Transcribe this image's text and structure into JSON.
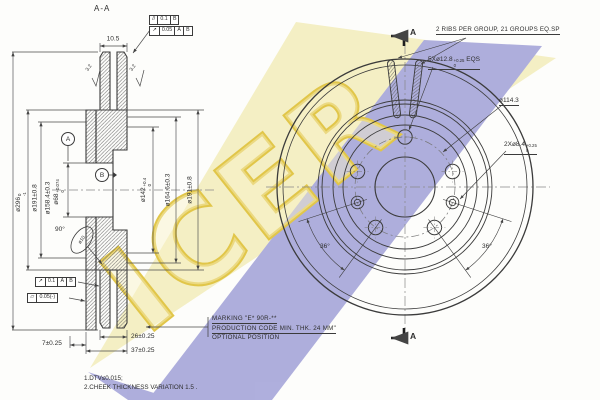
{
  "title": "A-A",
  "watermark": {
    "text": "ICER",
    "yellow": "#f4eec0",
    "blue": "#a9a9da",
    "letter": "#dfc23c"
  },
  "left_view": {
    "dim_top": "10.5",
    "finish_left": "3.2",
    "finish_right": "3.2",
    "dia296": {
      "main": "ø296",
      "tt": "0",
      "tb": "-1"
    },
    "dia191_left": "ø191±0.8",
    "dia158": "ø158.4±0.3",
    "dia68": {
      "main": "ø68",
      "tt": "+0.074",
      "tb": "0"
    },
    "dia142": {
      "main": "ø142",
      "tt": "+0.4",
      "tb": "0"
    },
    "dia164": "ø164.6±0.3",
    "dia191_right": "ø191±0.8",
    "angle90": "90°",
    "balloon": "ø10",
    "dim26": "26±0.25",
    "dim37": "37±0.25",
    "dim7": "7±0.25",
    "datumA": "A",
    "datumB": "B",
    "fcf_parallel": {
      "sym": "//",
      "val": "0.1",
      "r1": "B"
    },
    "fcf_runout_small": {
      "sym": "↗",
      "val": "0.05",
      "r1": "A",
      "r2": "B"
    },
    "fcf_runout": {
      "sym": "↗",
      "val": "0.1",
      "r1": "A",
      "r2": "B"
    },
    "fcf_flatness": {
      "sym": "▱",
      "val": "0.05(-)"
    }
  },
  "right_view": {
    "ribs_note": "2 RIBS PER GROUP, 21 GROUPS EQ.SP",
    "holes5": {
      "main": "5Xø12.8",
      "tt": "+0.25",
      "tb": "0",
      "suffix": "EQS"
    },
    "bolt_circle": "ø114.3",
    "holes2": {
      "main": "2Xø8.4",
      "tt": "+0.25",
      "tb": "0"
    },
    "angle_left": "36°",
    "angle_right": "36°",
    "flag_top": "A",
    "flag_bottom": "A"
  },
  "marking": {
    "line1": "MARKING \"E* 90R-**",
    "line2": "PRODUCTION CODE MIN. THK. 24 MM\"",
    "line3": "OPTIONAL POSITION"
  },
  "notes": {
    "n1": "1.DTV≤0.015;",
    "n2": "2.CHEEK THICKNESS VARIATION 1.5 ."
  }
}
